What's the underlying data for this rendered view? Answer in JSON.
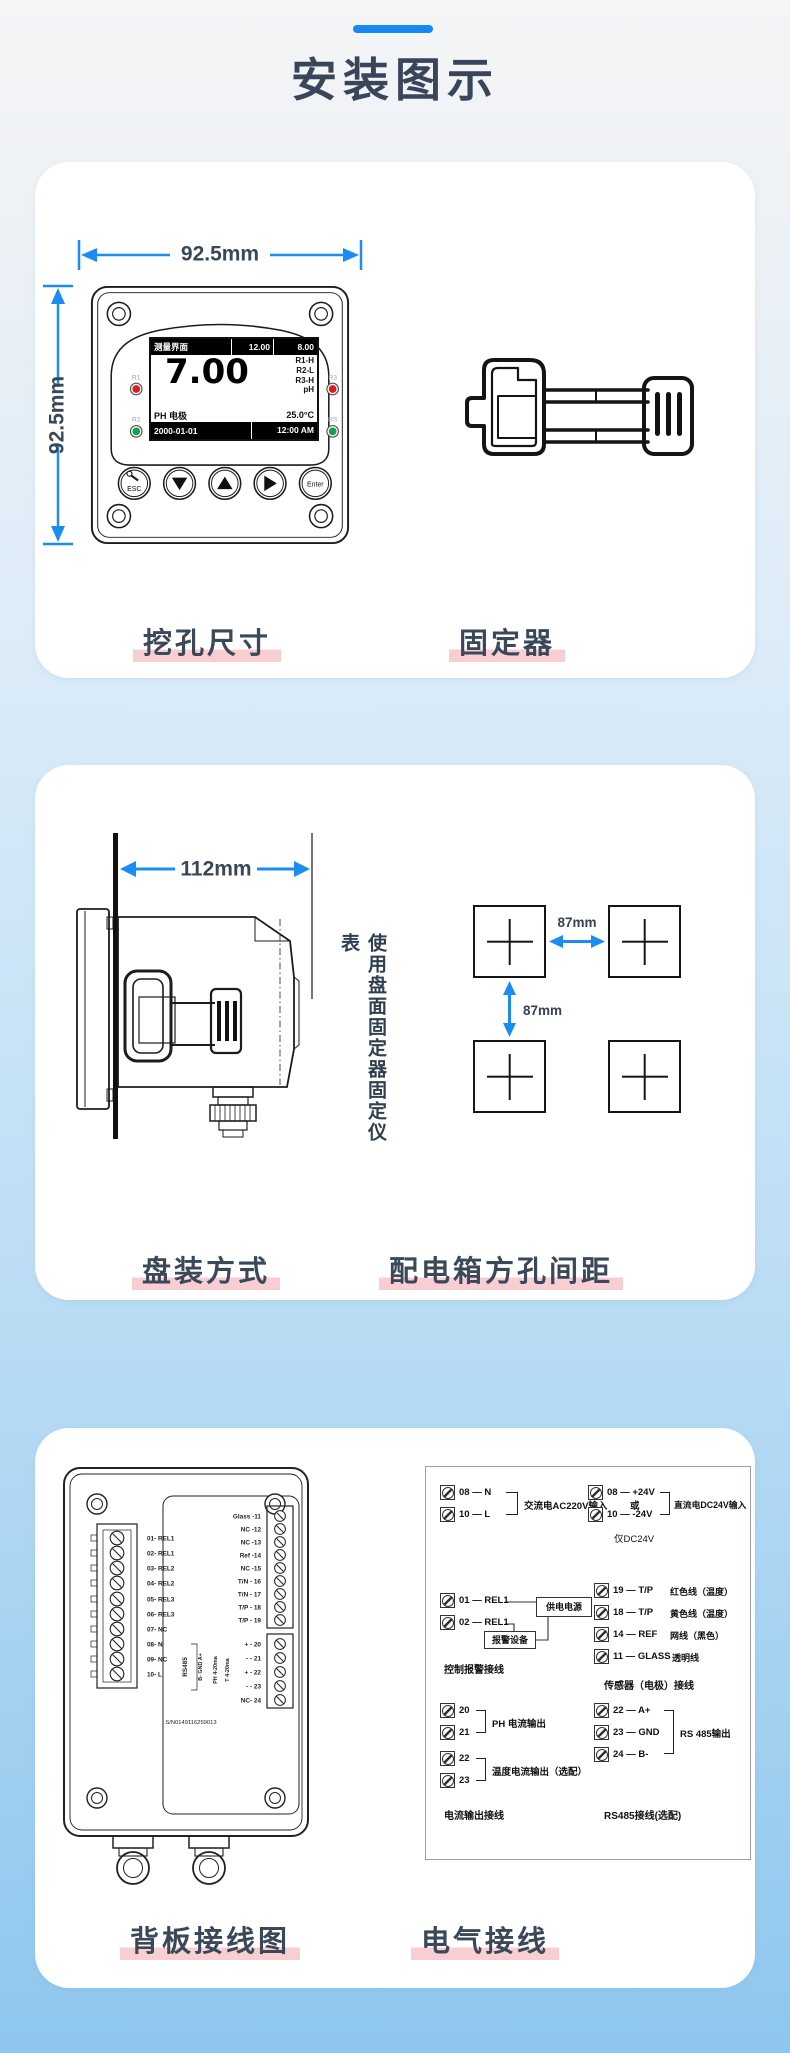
{
  "page": {
    "title": "安装图示"
  },
  "colors": {
    "accent_blue": "#1b8cf2",
    "underline_pink": "#f8ced3",
    "title_text": "#3b4859",
    "led_red": "#dd1c1c",
    "led_green": "#12a151"
  },
  "card1": {
    "dim_width": "92.5mm",
    "dim_height": "92.5mm",
    "caption_left": "挖孔尺寸",
    "caption_right": "固定器",
    "screen": {
      "menu": "测量界面",
      "sp1": "12.00",
      "sp2": "8.00",
      "main": "7.00",
      "r1": "R1-H",
      "r2": "R2-L",
      "r3": "R3-H",
      "unit": "pH",
      "probe": "PH 电极",
      "temp": "25.0°C",
      "date": "2000-01-01",
      "time": "12:00 AM"
    },
    "leds": {
      "l1": "R1",
      "l2": "R2",
      "l3": "R3",
      "l4": "RS"
    },
    "buttons": {
      "esc": "ESC",
      "enter": "Enter"
    }
  },
  "card2": {
    "dim": "112mm",
    "note": "使用盘面固定器固定仪表",
    "gap_h": "87mm",
    "gap_v": "87mm",
    "caption_left": "盘装方式",
    "caption_right": "配电箱方孔间距"
  },
  "card3": {
    "caption_left": "背板接线图",
    "caption_right": "电气接线",
    "backpanel": {
      "left_terminals": [
        "01- REL1",
        "02- REL1",
        "03- REL2",
        "04- REL2",
        "05- REL3",
        "06- REL3",
        "07- NC",
        "08- N",
        "09- NC",
        "10- L"
      ],
      "right_terminals": [
        "Glass -11",
        "NC -12",
        "NC -13",
        "Ref -14",
        "NC -15",
        "T/N - 16",
        "T/N - 17",
        "T/P - 18",
        "T/P - 19"
      ],
      "lower_terminals": [
        "+ - 20",
        "- - 21",
        "+ - 22",
        "- - 23",
        "NC- 24"
      ],
      "rs485": "RS485",
      "rs485_pins": "B- GND A+",
      "ph_out": "PH 4-20ma",
      "t_out": "T 4-20ma",
      "serial": "S/N0149116259013"
    },
    "wiring": {
      "ac": {
        "pins": [
          "08 — N",
          "10 — L"
        ],
        "label": "交流电AC220V输入",
        "or_word": "或"
      },
      "dc": {
        "pins": [
          "08 — +24V",
          "10 — -24V"
        ],
        "label": "直流电DC24V输入",
        "note": "仅DC24V"
      },
      "relay": {
        "pins": [
          "01 — REL1",
          "02 — REL1"
        ],
        "box_power": "供电电源",
        "box_alarm": "报警设备",
        "caption": "控制报警接线"
      },
      "sensor": {
        "rows": [
          {
            "pin": "19 — T/P",
            "desc": "红色线（温度）"
          },
          {
            "pin": "18 — T/P",
            "desc": "黄色线（温度）"
          },
          {
            "pin": "14 — REF",
            "desc": "网线（黑色）"
          },
          {
            "pin": "11 — GLASS",
            "desc": "透明线"
          }
        ],
        "caption": "传感器（电极）接线"
      },
      "current": {
        "pins_ph": [
          "20",
          "21"
        ],
        "label_ph": "PH 电流输出",
        "pins_t": [
          "22",
          "23"
        ],
        "label_t": "温度电流输出（选配）",
        "caption": "电流输出接线"
      },
      "rs": {
        "pins": [
          "22 — A+",
          "23 — GND",
          "24 — B-"
        ],
        "label": "RS 485输出",
        "caption": "RS485接线(选配)"
      }
    }
  }
}
